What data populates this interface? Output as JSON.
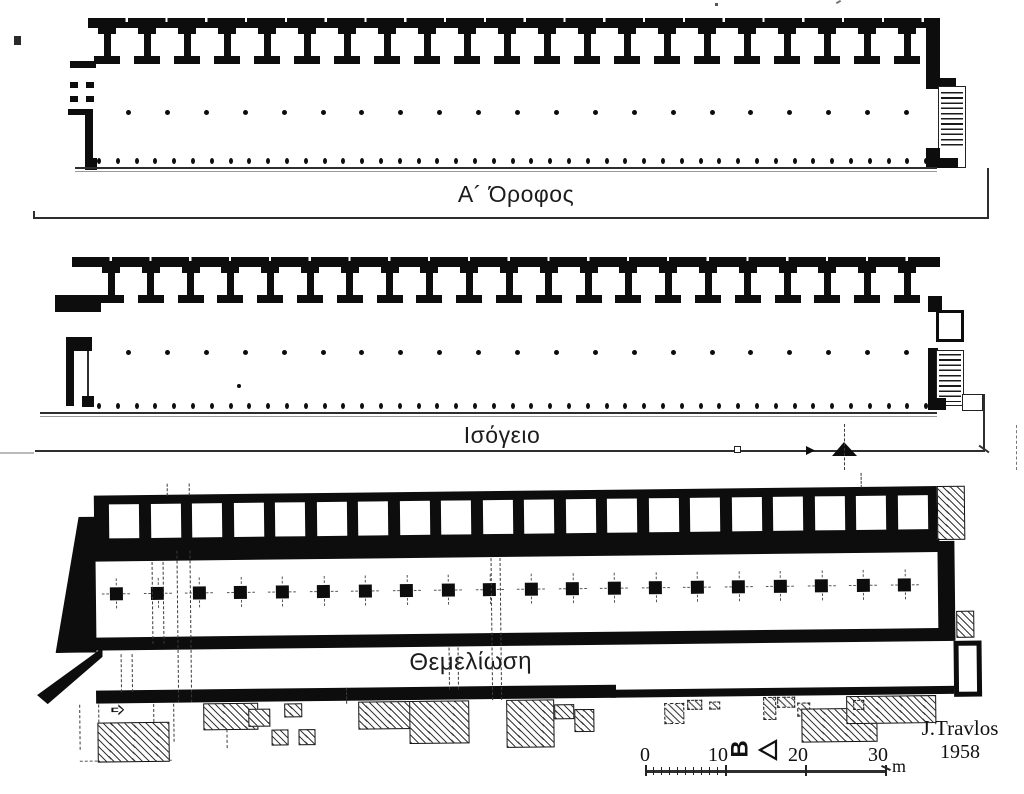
{
  "drawing": {
    "type": "architectural-floor-plans",
    "credit": {
      "author": "J.Travlos",
      "year": "1958"
    },
    "north": {
      "letter": "Β"
    },
    "scale_bar": {
      "ticks": [
        "0",
        "10",
        "20",
        "30"
      ],
      "unit": "m"
    }
  },
  "plans": {
    "floor1": {
      "label": "Α´ Όροφος",
      "piers": 21,
      "interior_columns": 21,
      "front_columns": 45
    },
    "ground": {
      "label": "Ισόγειο",
      "piers": 21,
      "interior_columns": 21,
      "front_columns": 45,
      "stray_dot": {
        "x": 237,
        "y": 384
      }
    },
    "foundation": {
      "label": "Θεμελίωση",
      "room_cells": 20,
      "column_footings": 20
    }
  },
  "ruins": {
    "fragments": [
      {
        "x": 96,
        "y": 718,
        "w": 72,
        "h": 40,
        "b": "solid"
      },
      {
        "x": 202,
        "y": 700,
        "w": 55,
        "h": 27,
        "b": "solid"
      },
      {
        "x": 247,
        "y": 706,
        "w": 22,
        "h": 18,
        "b": "solid"
      },
      {
        "x": 283,
        "y": 701,
        "w": 18,
        "h": 14,
        "b": "solid"
      },
      {
        "x": 270,
        "y": 727,
        "w": 17,
        "h": 16,
        "b": "solid"
      },
      {
        "x": 297,
        "y": 727,
        "w": 17,
        "h": 16,
        "b": "solid"
      },
      {
        "x": 357,
        "y": 700,
        "w": 80,
        "h": 28,
        "b": "solid"
      },
      {
        "x": 408,
        "y": 700,
        "w": 60,
        "h": 43,
        "b": "solid"
      },
      {
        "x": 505,
        "y": 700,
        "w": 48,
        "h": 48,
        "b": "solid"
      },
      {
        "x": 553,
        "y": 705,
        "w": 20,
        "h": 15,
        "b": "solid"
      },
      {
        "x": 573,
        "y": 710,
        "w": 20,
        "h": 23,
        "b": "solid"
      },
      {
        "x": 663,
        "y": 705,
        "w": 20,
        "h": 21,
        "b": "dashed"
      },
      {
        "x": 686,
        "y": 702,
        "w": 15,
        "h": 10,
        "b": "dashed"
      },
      {
        "x": 708,
        "y": 704,
        "w": 11,
        "h": 8,
        "b": "dashed"
      },
      {
        "x": 762,
        "y": 700,
        "w": 13,
        "h": 23,
        "b": "dashed"
      },
      {
        "x": 776,
        "y": 700,
        "w": 18,
        "h": 11,
        "b": "dashed"
      },
      {
        "x": 796,
        "y": 706,
        "w": 13,
        "h": 14,
        "b": "dashed"
      },
      {
        "x": 800,
        "y": 712,
        "w": 76,
        "h": 34,
        "b": "solid"
      },
      {
        "x": 845,
        "y": 700,
        "w": 90,
        "h": 28,
        "b": "solid"
      },
      {
        "x": 852,
        "y": 704,
        "w": 11,
        "h": 10,
        "b": "dashed"
      }
    ]
  }
}
